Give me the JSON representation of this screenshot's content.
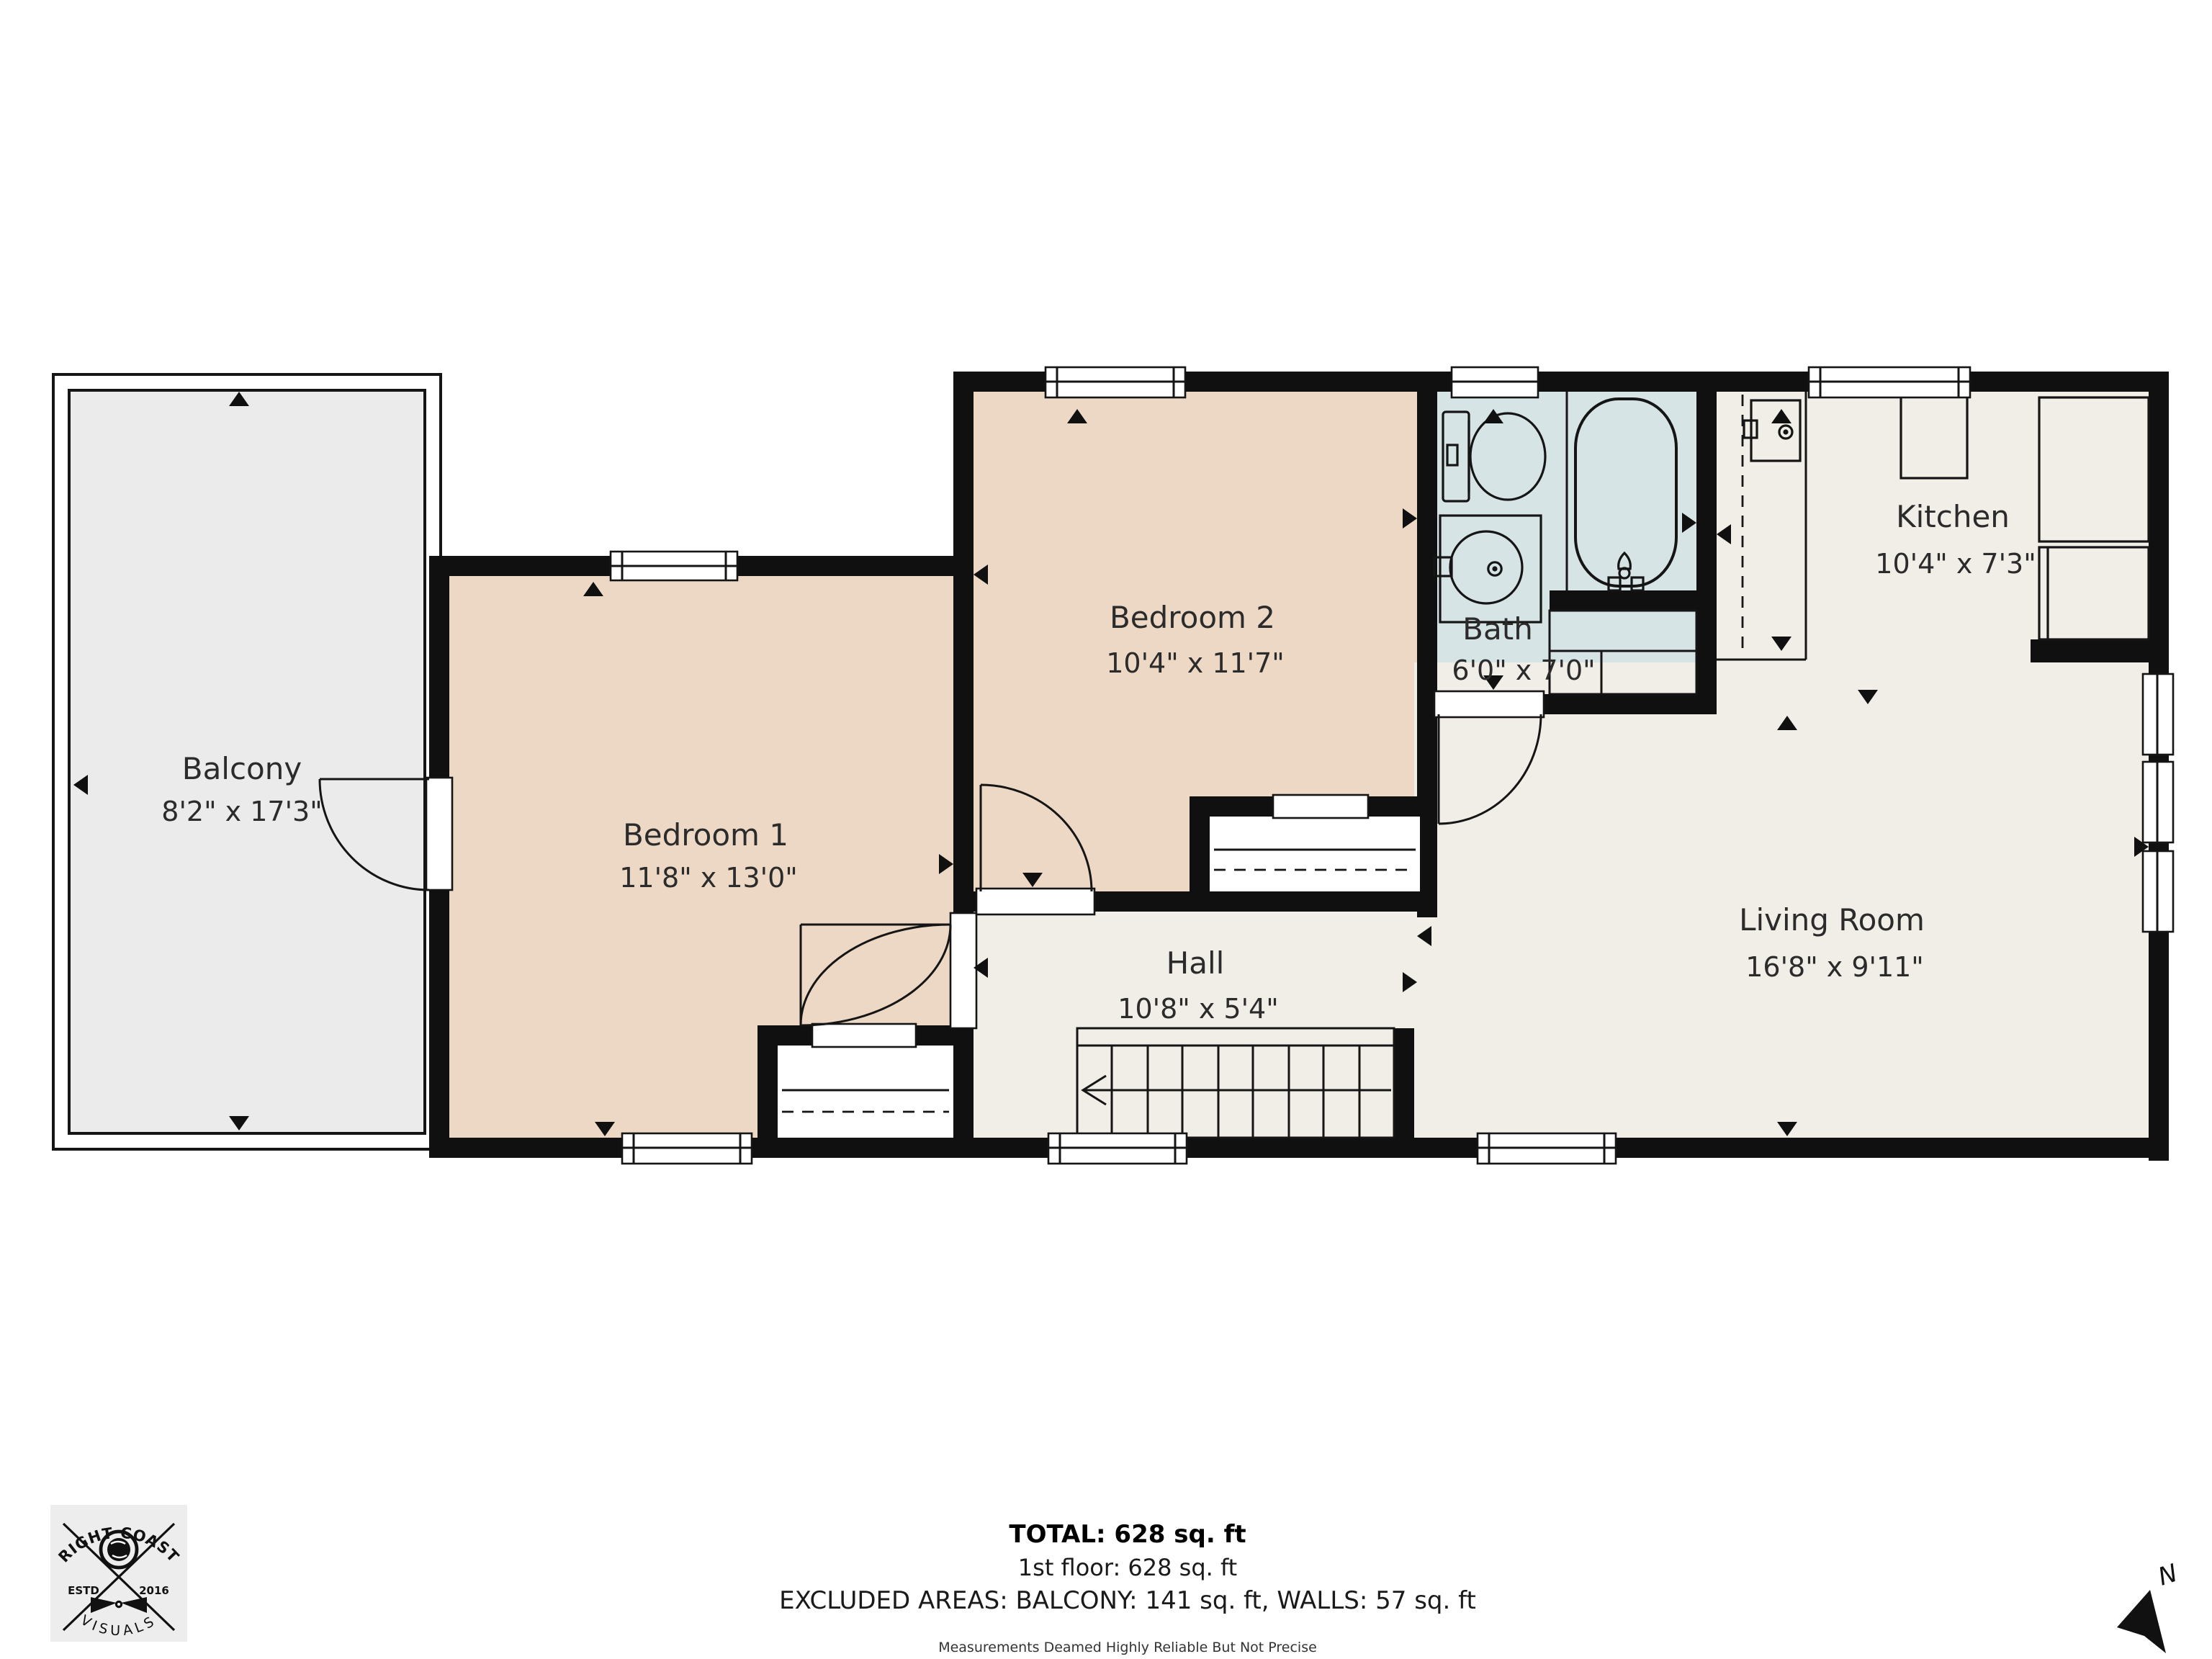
{
  "colors": {
    "wall": "#101010",
    "bedroom_fill": "#ecd8c5",
    "bath_fill": "#d7e4e6",
    "floor_fill": "#f1ede7",
    "balcony_fill": "#ebebeb",
    "background": "#ffffff"
  },
  "rooms": {
    "balcony": {
      "label": "Balcony",
      "dims": "8'2\" x 17'3\""
    },
    "bedroom1": {
      "label": "Bedroom 1",
      "dims": "11'8\" x 13'0\""
    },
    "bedroom2": {
      "label": "Bedroom 2",
      "dims": "10'4\" x 11'7\""
    },
    "bath": {
      "label": "Bath",
      "dims": "6'0\" x 7'0\""
    },
    "kitchen": {
      "label": "Kitchen",
      "dims": "10'4\" x 7'3\""
    },
    "living_room": {
      "label": "Living Room",
      "dims": "16'8\" x 9'11\""
    },
    "hall": {
      "label": "Hall",
      "dims": "10'8\" x 5'4\""
    }
  },
  "summary": {
    "total": "TOTAL: 628 sq. ft",
    "floor": "1st floor: 628 sq. ft",
    "excluded": "EXCLUDED AREAS: BALCONY: 141 sq. ft, WALLS: 57 sq. ft",
    "disclaimer": "Measurements Deamed Highly Reliable But Not Precise"
  },
  "logo": {
    "title": "RIGHT COAST",
    "estd": "ESTD",
    "year": "2016",
    "subtitle": "VISUALS"
  },
  "compass": {
    "north_label": "N"
  }
}
